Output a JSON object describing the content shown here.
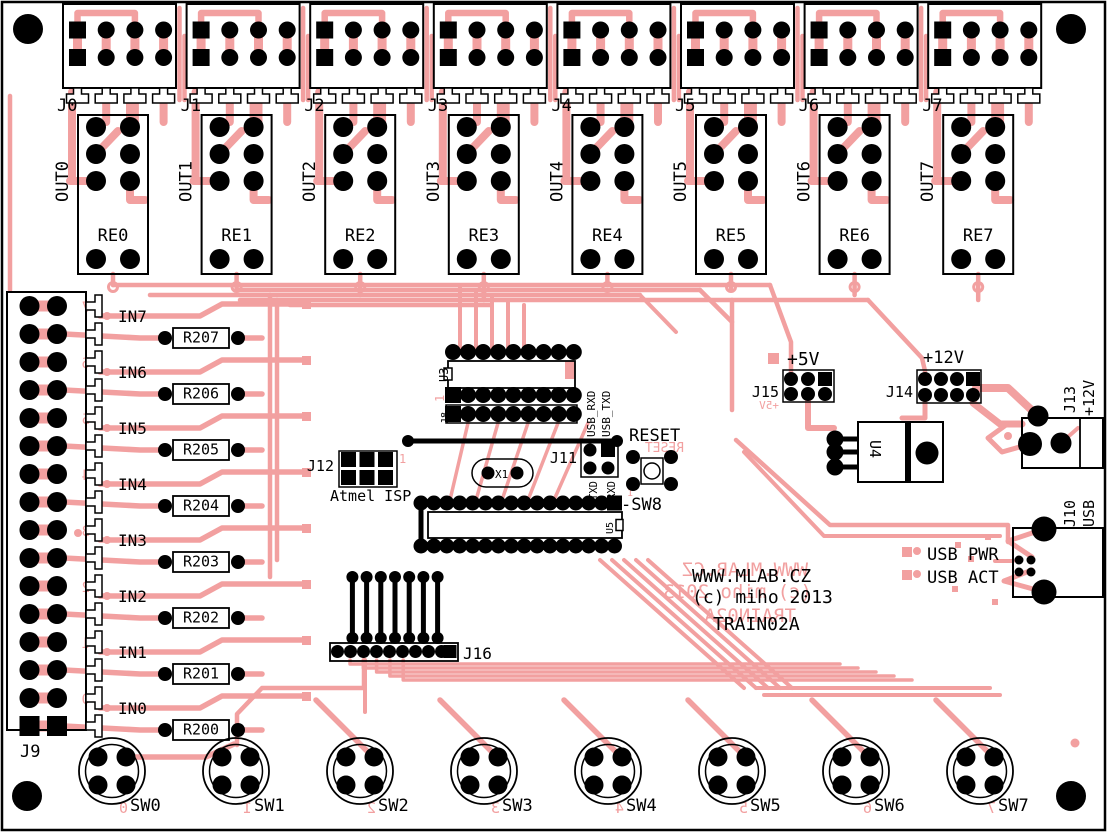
{
  "board": {
    "brand": [
      "WWW.MLAB.CZ",
      "(c) miho 2013",
      "TRAIN02A"
    ],
    "colors": {
      "copper": "#f2a0a0",
      "silkscreen": "#000000",
      "background": "#ffffff"
    }
  },
  "top_connectors": [
    "J0",
    "J1",
    "J2",
    "J3",
    "J4",
    "J5",
    "J6",
    "J7"
  ],
  "relays": [
    "RE0",
    "RE1",
    "RE2",
    "RE3",
    "RE4",
    "RE5",
    "RE6",
    "RE7"
  ],
  "outputs": [
    "OUT0",
    "OUT1",
    "OUT2",
    "OUT3",
    "OUT4",
    "OUT5",
    "OUT6",
    "OUT7"
  ],
  "j9": {
    "ref": "J9",
    "inputs": [
      "IN7",
      "IN6",
      "IN5",
      "IN4",
      "IN3",
      "IN2",
      "IN1",
      "IN0"
    ],
    "resistors": [
      "R207",
      "R206",
      "R205",
      "R204",
      "R203",
      "R202",
      "R201",
      "R200"
    ],
    "digits": [
      "7",
      "6",
      "5",
      "4",
      "3",
      "2",
      "1",
      "0"
    ]
  },
  "ics": {
    "u3": "U3",
    "u4": "U4",
    "u5": "U5"
  },
  "headers": {
    "j8": "J8",
    "j11": "J11",
    "j12": "J12",
    "j14": "J14",
    "j15": "J15",
    "j16": "J16"
  },
  "isp": {
    "label": "Atmel ISP"
  },
  "serial": {
    "txd": "TXD",
    "rxd": "RXD",
    "usb_rxd": "USB_RXD",
    "usb_txd": "USB_TXD"
  },
  "crystal": {
    "ref": "X1"
  },
  "reset": {
    "label": "RESET",
    "sw": "-SW8"
  },
  "misc": {
    "pin1": "1"
  },
  "power": {
    "plus5": "+5V",
    "plus12": "+12V",
    "j13": "J13",
    "j13v": "+12V"
  },
  "usb": {
    "j10": "J10",
    "usb": "USB",
    "pwr": "USB PWR",
    "act": "USB ACT"
  },
  "switches": {
    "labels": [
      "SW0",
      "SW1",
      "SW2",
      "SW3",
      "SW4",
      "SW5",
      "SW6",
      "SW7"
    ],
    "digits": [
      "0",
      "1",
      "2",
      "3",
      "4",
      "5",
      "6",
      "7"
    ]
  }
}
